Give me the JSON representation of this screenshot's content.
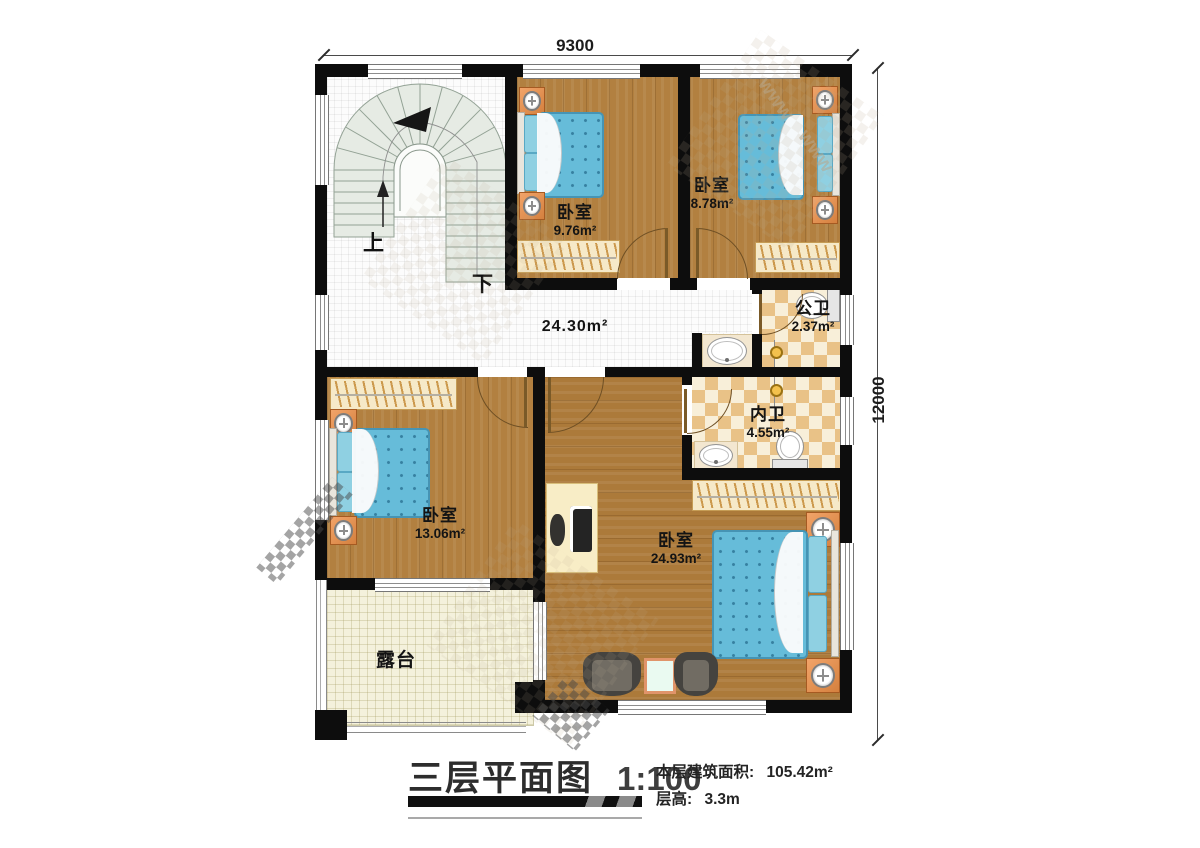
{
  "dims": {
    "top": "9300",
    "right": "12000"
  },
  "stairs": {
    "up": "上",
    "down": "下"
  },
  "rooms": {
    "bd1": {
      "name": "卧室",
      "area": "9.76m²"
    },
    "bd2": {
      "name": "卧室",
      "area": "8.78m²"
    },
    "hall": {
      "area": "24.30m²"
    },
    "pubbath": {
      "name": "公卫",
      "area": "2.37m²"
    },
    "innbath": {
      "name": "内卫",
      "area": "4.55m²"
    },
    "bd3": {
      "name": "卧室",
      "area": "13.06m²"
    },
    "master": {
      "name": "卧室",
      "area": "24.93m²"
    },
    "terrace": {
      "name": "露台"
    }
  },
  "title": {
    "text": "三层平面图",
    "scale": "1:100"
  },
  "info": {
    "area_label": "本层建筑面积:",
    "area_value": "105.42m²",
    "floor_label": "层高:",
    "floor_value": "3.3m"
  },
  "colors": {
    "wall": "#0d0d0d",
    "wood": "#b28040",
    "checker_tile": "#e9c287",
    "mattress": "#66bcd9",
    "nightstand": "#e0874f",
    "terrace": "#f4f1dc"
  }
}
